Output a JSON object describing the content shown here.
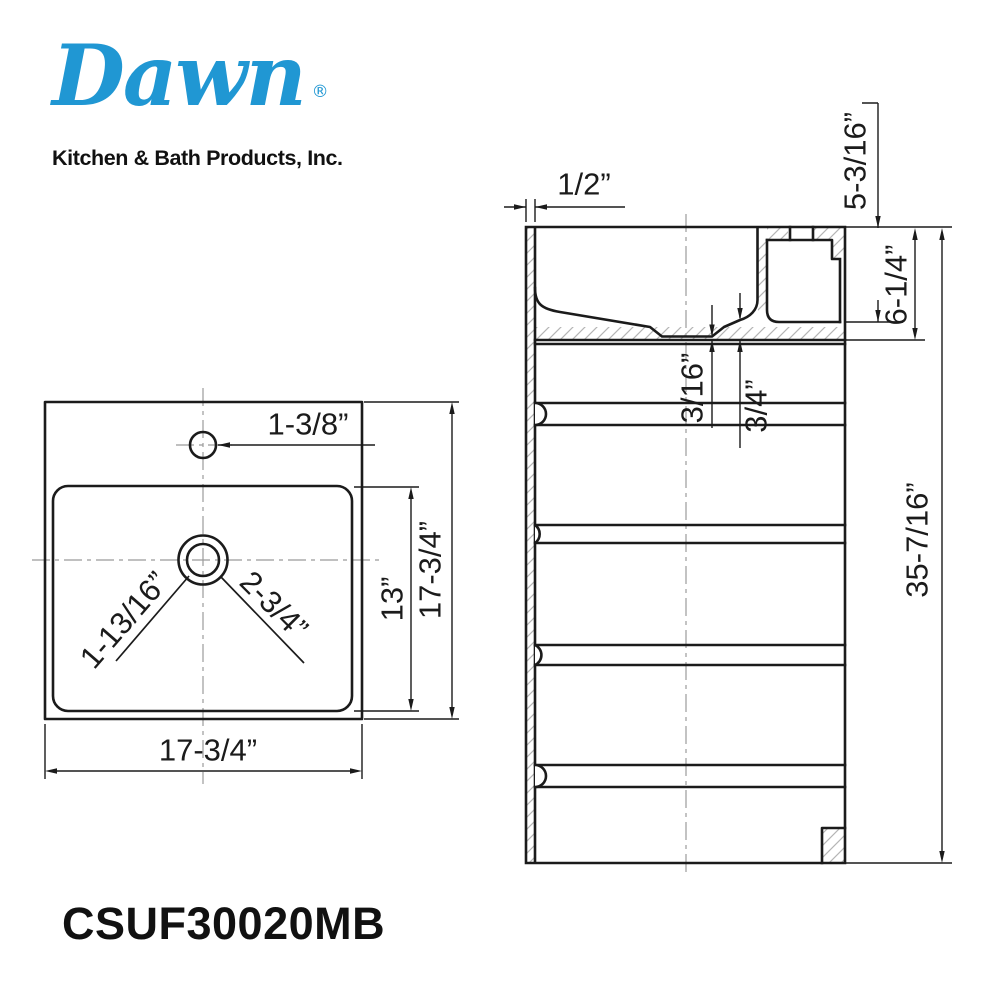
{
  "logo": {
    "brand": "Dawn",
    "registered": "®",
    "tagline": "Kitchen & Bath Products, Inc."
  },
  "model_number": "CSUF30020MB",
  "colors": {
    "brand_blue": "#2097d3",
    "line": "#1b1b1b",
    "hatch": "#b5b5b5",
    "centerline": "#9b9b9b"
  },
  "front_view": {
    "dims": {
      "faucet_hole_diameter": "1-3/8”",
      "drain_offset_left": "1-13/16”",
      "drain_offset_right": "2-3/4”",
      "bowl_length": "13”",
      "overall_depth": "17-3/4”",
      "overall_width": "17-3/4”"
    }
  },
  "side_view": {
    "dims": {
      "rim_thickness": "1/2”",
      "bowl_depth": "5-3/16”",
      "deck_height": "6-1/4”",
      "drain_recess": "3/16”",
      "bottom_thickness": "3/4”",
      "overall_height": "35-7/16”"
    }
  }
}
